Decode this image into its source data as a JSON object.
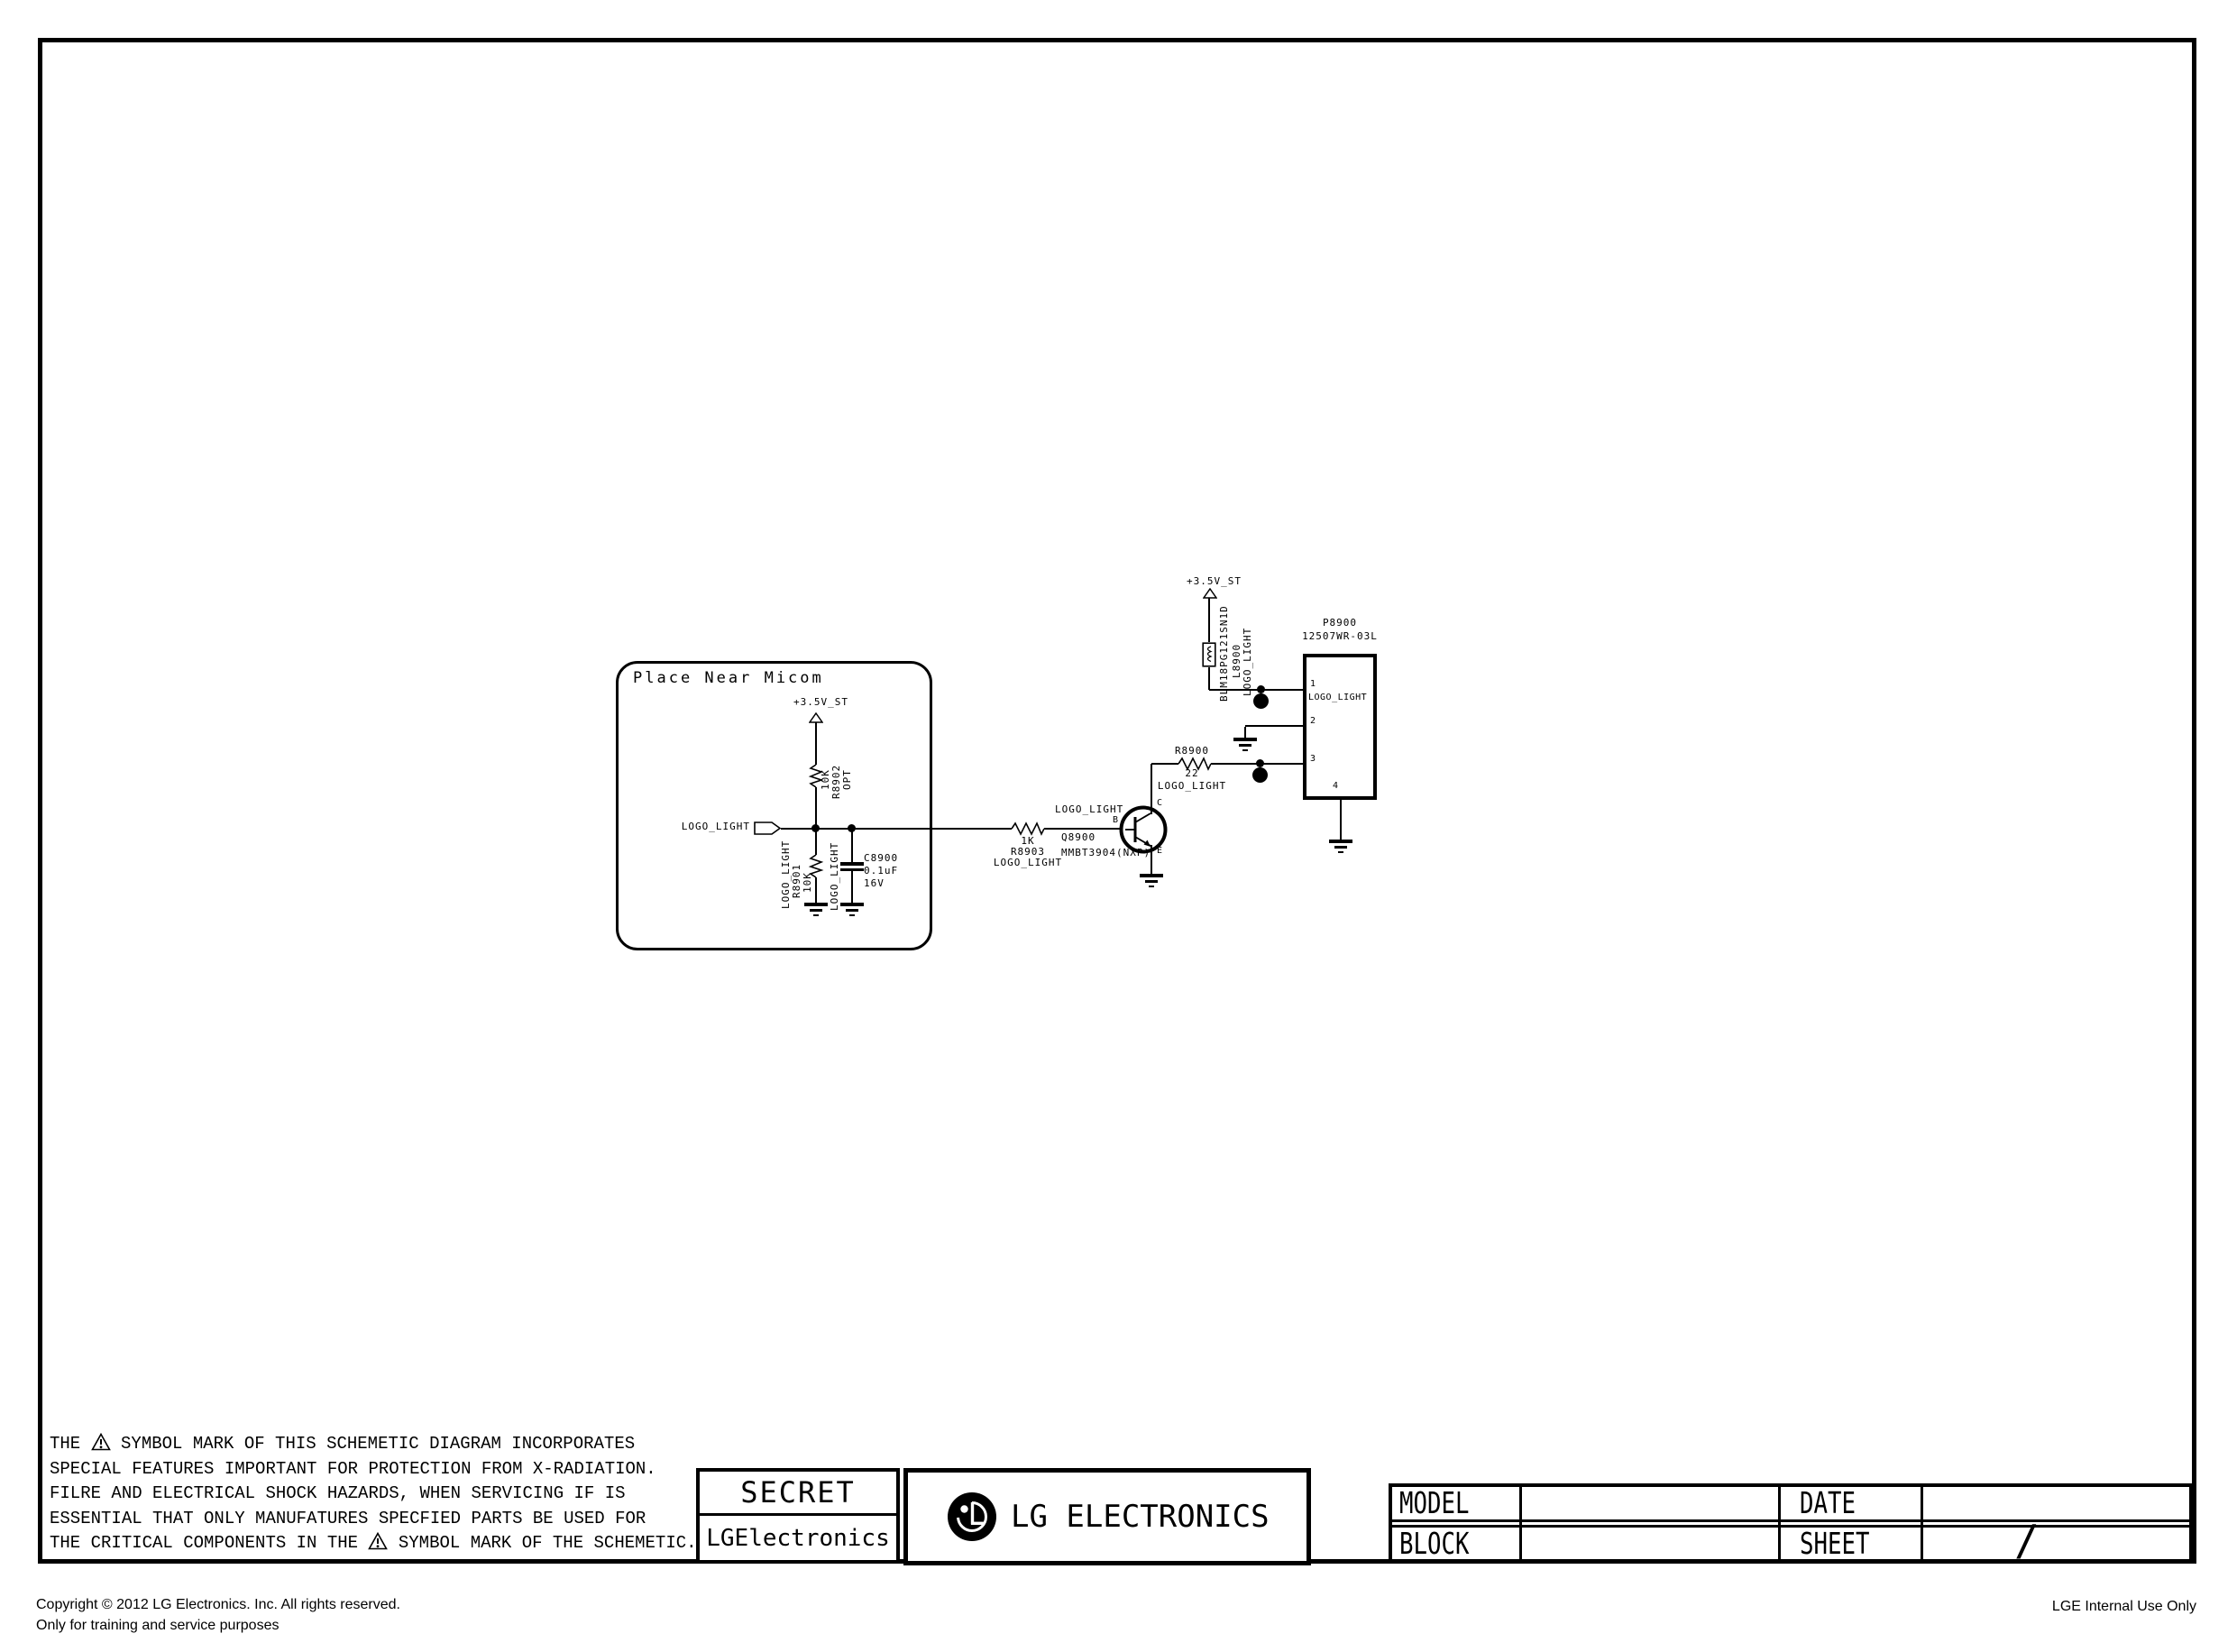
{
  "colors": {
    "line": "#000000",
    "bg": "#ffffff"
  },
  "schematic": {
    "micom": {
      "title": "Place Near Micom",
      "power": "+3.5V_ST",
      "input_net": "LOGO_LIGHT",
      "r8902": {
        "value": "10K",
        "ref": "R8902",
        "opt": "OPT"
      },
      "r8901": {
        "net": "LOGO_LIGHT",
        "ref": "R8901",
        "value": "10K"
      },
      "c8900": {
        "net": "LOGO_LIGHT",
        "ref": "C8900",
        "value": "0.1uF",
        "volt": "16V"
      }
    },
    "r8903": {
      "value": "1K",
      "ref": "R8903",
      "net": "LOGO_LIGHT"
    },
    "base_net": "LOGO_LIGHT",
    "q8900": {
      "ref": "Q8900",
      "part": "MMBT3904(NXP)",
      "b": "B",
      "c": "C",
      "e": "E"
    },
    "r8900": {
      "ref": "R8900",
      "value": "22",
      "net": "LOGO_LIGHT"
    },
    "l8900": {
      "power": "+3.5V_ST",
      "part": "BLM18PG121SN1D",
      "ref": "L8900",
      "net": "LOGO_LIGHT"
    },
    "p8900": {
      "ref": "P8900",
      "part": "12507WR-03L",
      "pin1": "1",
      "pin1_net": "LOGO_LIGHT",
      "pin2": "2",
      "pin3": "3",
      "pin4": "4"
    }
  },
  "warning": {
    "l1a": "THE",
    "l1b": "SYMBOL MARK OF THIS SCHEMETIC DIAGRAM INCORPORATES",
    "l2": "SPECIAL FEATURES IMPORTANT FOR PROTECTION FROM X-RADIATION.",
    "l3": "FILRE AND ELECTRICAL SHOCK HAZARDS, WHEN SERVICING IF IS",
    "l4": "ESSENTIAL THAT ONLY MANUFATURES SPECFIED PARTS BE USED FOR",
    "l5a": "THE CRITICAL COMPONENTS IN THE",
    "l5b": "SYMBOL MARK OF THE SCHEMETIC."
  },
  "titleblock": {
    "secret": "SECRET",
    "company": "LGElectronics",
    "logo": "LG ELECTRONICS",
    "model": "MODEL",
    "block": "BLOCK",
    "date": "DATE",
    "sheet": "SHEET",
    "sheet_value": "/"
  },
  "footer": {
    "copyright": "Copyright © 2012 LG Electronics. Inc. All rights reserved.",
    "training": "Only for training and service purposes",
    "internal": "LGE Internal Use Only"
  }
}
